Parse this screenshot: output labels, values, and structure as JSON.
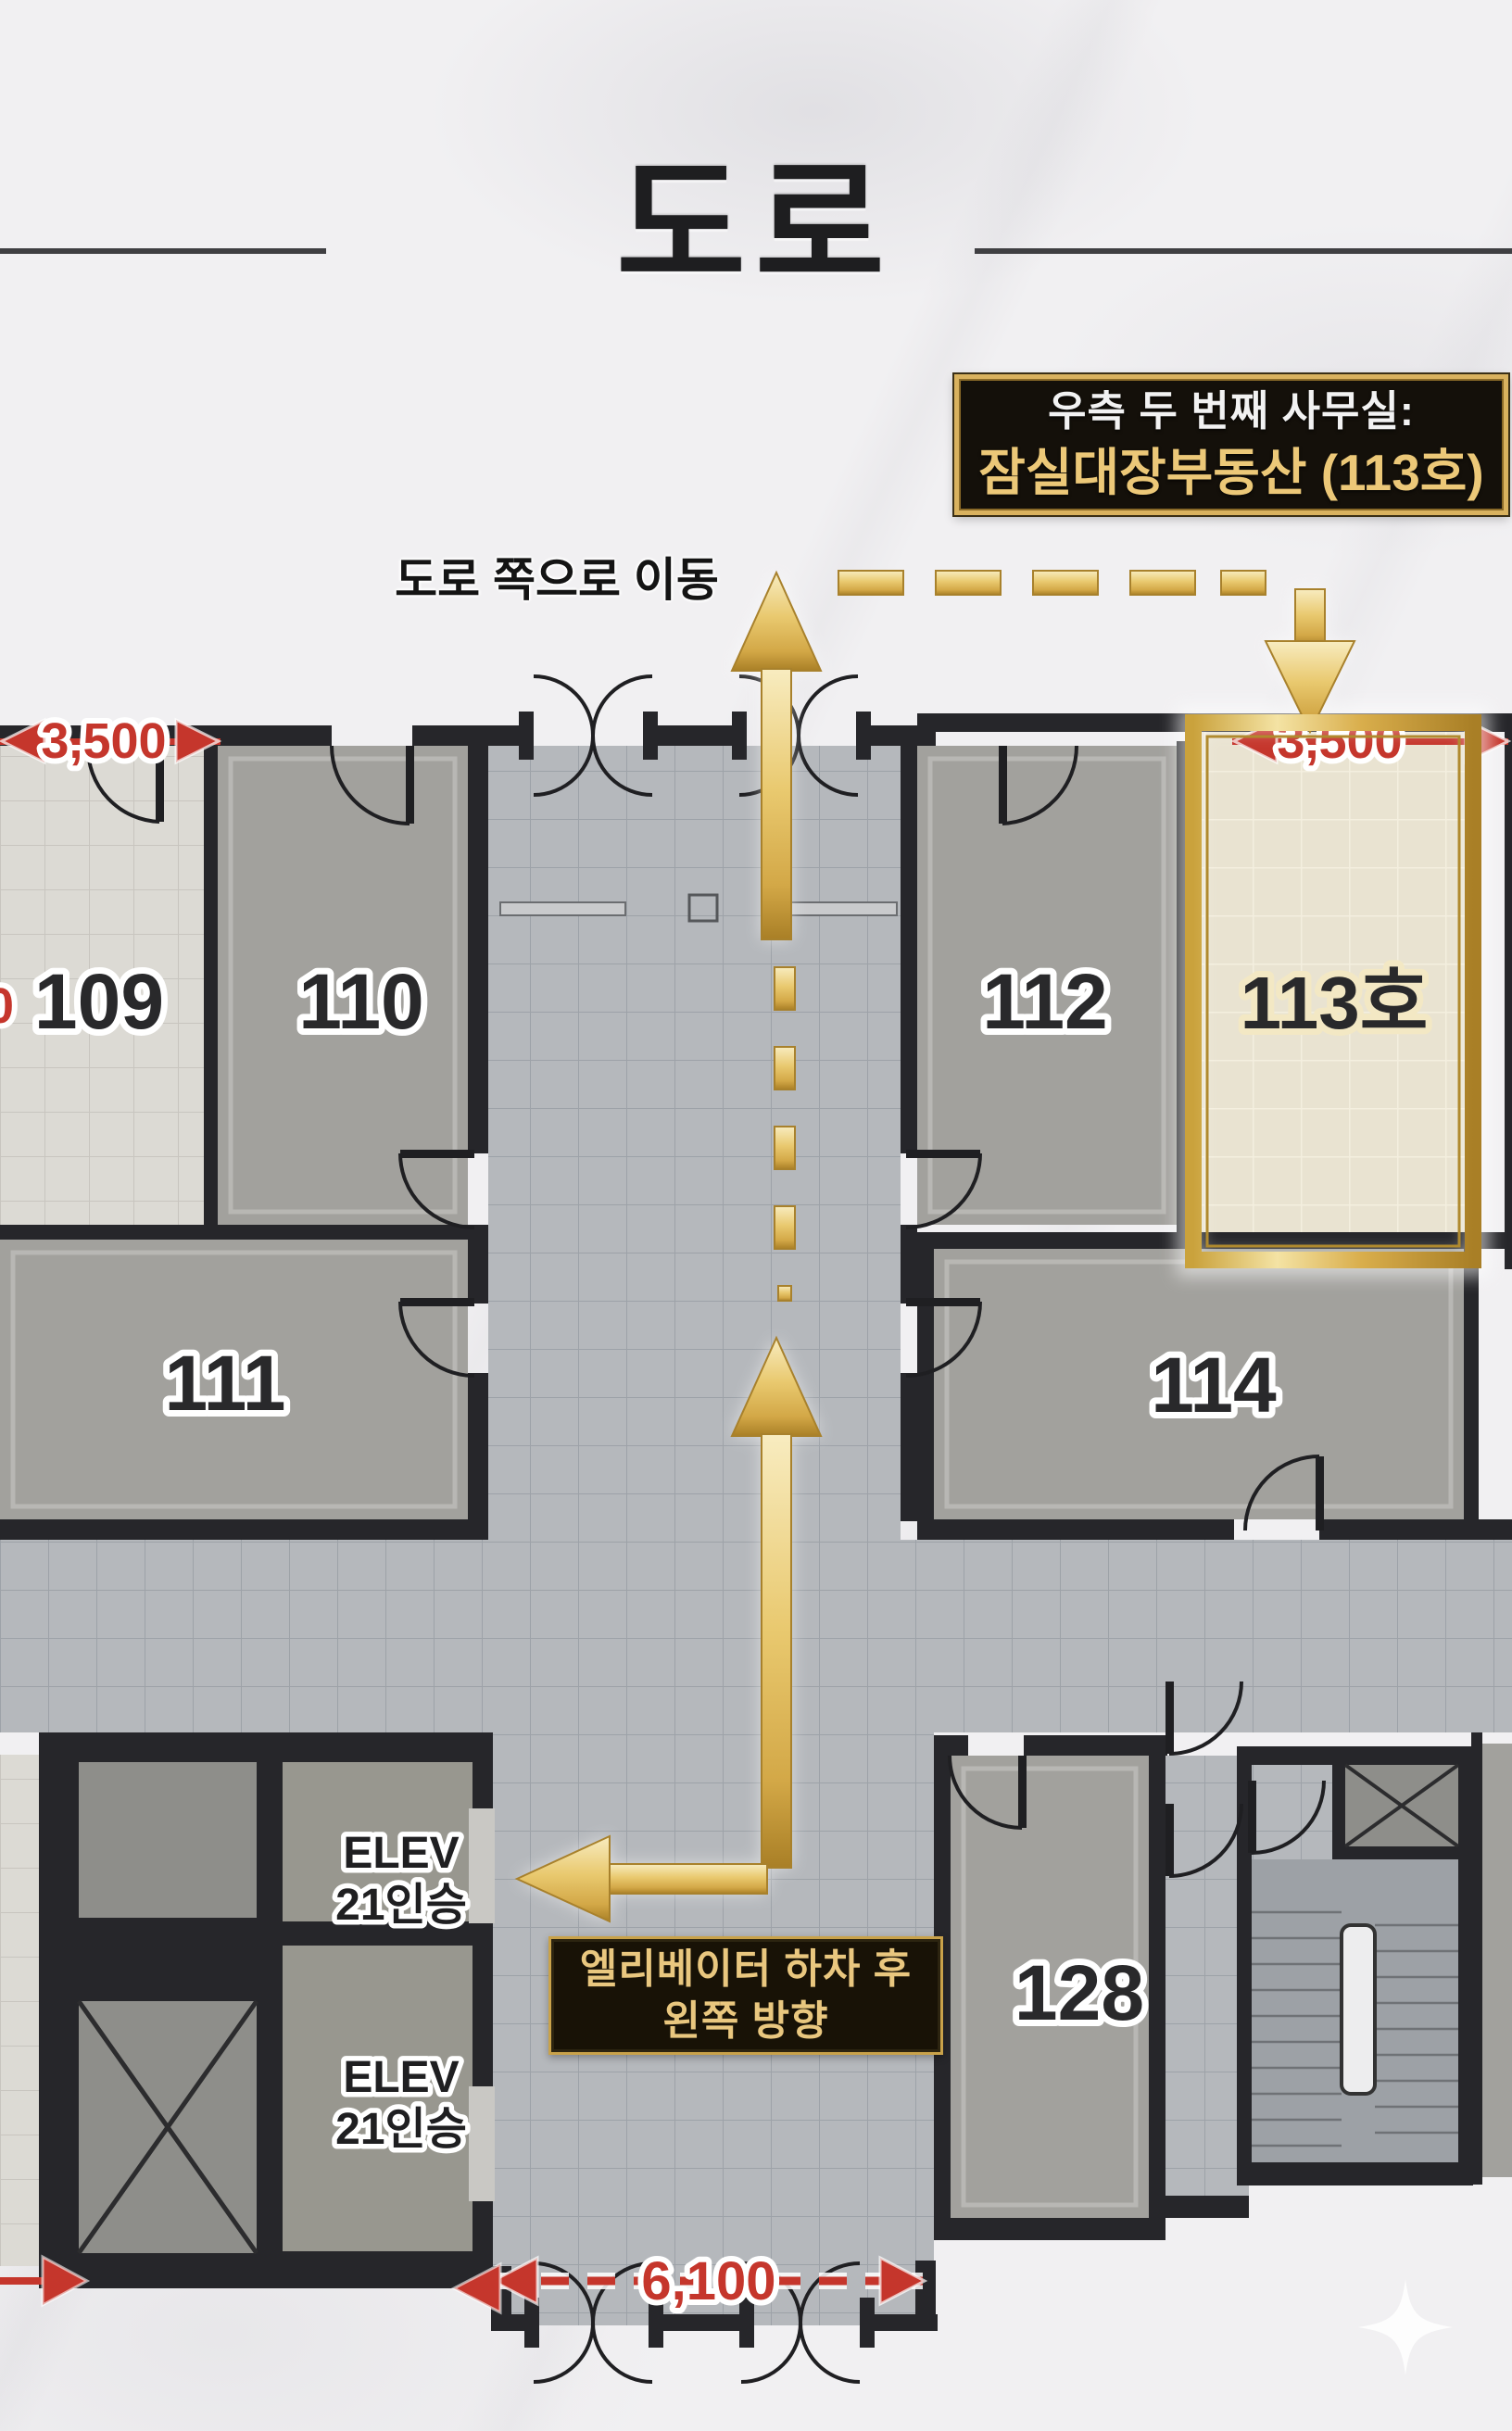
{
  "title": "도로",
  "callout": {
    "line1": "우측 두 번째 사무실:",
    "line2": "잠실대장부동산 (113호)"
  },
  "move_label": "도로 쪽으로 이동",
  "instruction": {
    "line1": "엘리베이터 하차 후",
    "line2": "왼쪽 방향"
  },
  "rooms": {
    "r109": "109",
    "r110": "110",
    "r111": "111",
    "r112": "112",
    "r113": "113호",
    "r114": "114",
    "r128": "128"
  },
  "elevator": {
    "top": {
      "line1": "ELEV",
      "line2": "21인승"
    },
    "bottom": {
      "line1": "ELEV",
      "line2": "21인승"
    }
  },
  "dimensions": {
    "left": "3,500",
    "right": "3,500",
    "bottom": "6,100",
    "edge_digit": "0"
  },
  "colors": {
    "gold": "#d9ab4a",
    "red": "#c5362c",
    "wall": "#26262a",
    "callout_bg": "#14100a",
    "callout_text_accent": "#ecc878",
    "highlight_room": "#e9e3d1"
  }
}
